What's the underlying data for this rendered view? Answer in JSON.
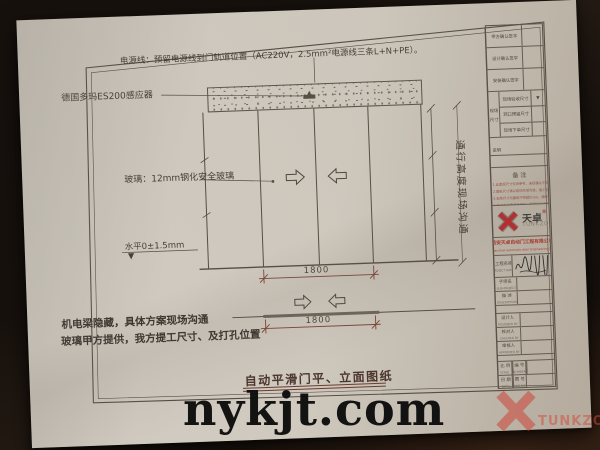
{
  "colors": {
    "paper": "#cfc9bf",
    "background": "#17110d",
    "ink": "#453d34",
    "dim_red": "#7d4438",
    "brand_red": "#c1272d"
  },
  "watermark": {
    "site": "nykjt.com",
    "corner_brand": "TUNKZO"
  },
  "annotations": {
    "power_note": "电源线：预留电源线到门轨道位置（AC220V，2.5mm²电源线三条L+N+PE）。",
    "sensor_label": "德国多玛ES200感应器",
    "glass_label": "玻璃：12mm钢化安全玻璃",
    "level_label": "水平0±1.5mm",
    "level_mark": "▼",
    "passage_note": "通行高度现场沟通",
    "site_note_1": "机电梁隐藏，具体方案现场沟通",
    "site_note_2": "玻璃甲方提供，我方提工尺寸、及打孔位置",
    "drawing_title": "自动平滑门平、立面图纸",
    "dim_elevation": "1800",
    "dim_plan": "1800"
  },
  "title_block": {
    "signature_rows": [
      {
        "label": "甲方确认签字"
      },
      {
        "label": "设计确认签字"
      },
      {
        "label": "安装确认签字"
      }
    ],
    "site_size": {
      "group_label_1": "现场",
      "group_label_2": "尺寸",
      "rows": [
        {
          "label": "现场验收尺寸",
          "mark": "▼"
        },
        {
          "label": "洞口预留尺寸",
          "mark": ""
        },
        {
          "label": "现场下单尺寸",
          "mark": ""
        }
      ]
    },
    "remark_label": "说明",
    "remark_text": "以现场实测尺寸为准",
    "notes": {
      "header": "备  注",
      "lines": [
        "1.此图纸尺寸仅供参考，未经确认不得施工。",
        "2.图纸尺寸请以现场实测为准，施工前核对。",
        "3.现场尺寸与图纸不符超5mm，请联系我司。",
        "4.施工方注意成品保护，职责划分清晰。"
      ]
    },
    "logo": {
      "cn": "天卓",
      "reg": "®",
      "en": "TUNKZO"
    },
    "company_cn": "西安天卓自动门工程有限公司",
    "company_en": "Xi'an Tianzhuo automatic door Engineering Co. Ltd",
    "fields": {
      "project": {
        "label": "工程名称",
        "en": "PROJECT NAME"
      },
      "sub": {
        "label": "子项名",
        "en": "SUB-PROJECT"
      },
      "desc": {
        "label": "描 述",
        "en": "DESCRIPTION"
      },
      "designer": {
        "label": "设计人",
        "en": "DESIGNED BY"
      },
      "checker": {
        "label": "校对人",
        "en": "CHECKED BY"
      },
      "approver": {
        "label": "审核人",
        "en": "APPROVED BY"
      }
    },
    "bottom_grid": {
      "scale": {
        "label": "比 例",
        "en": "SCALE"
      },
      "number": {
        "label": "编 号",
        "en": "NUMBER"
      },
      "date": {
        "label": "日 期",
        "en": "DATE"
      },
      "dwg": {
        "label": "图 号",
        "en": "DWG NO."
      }
    }
  }
}
